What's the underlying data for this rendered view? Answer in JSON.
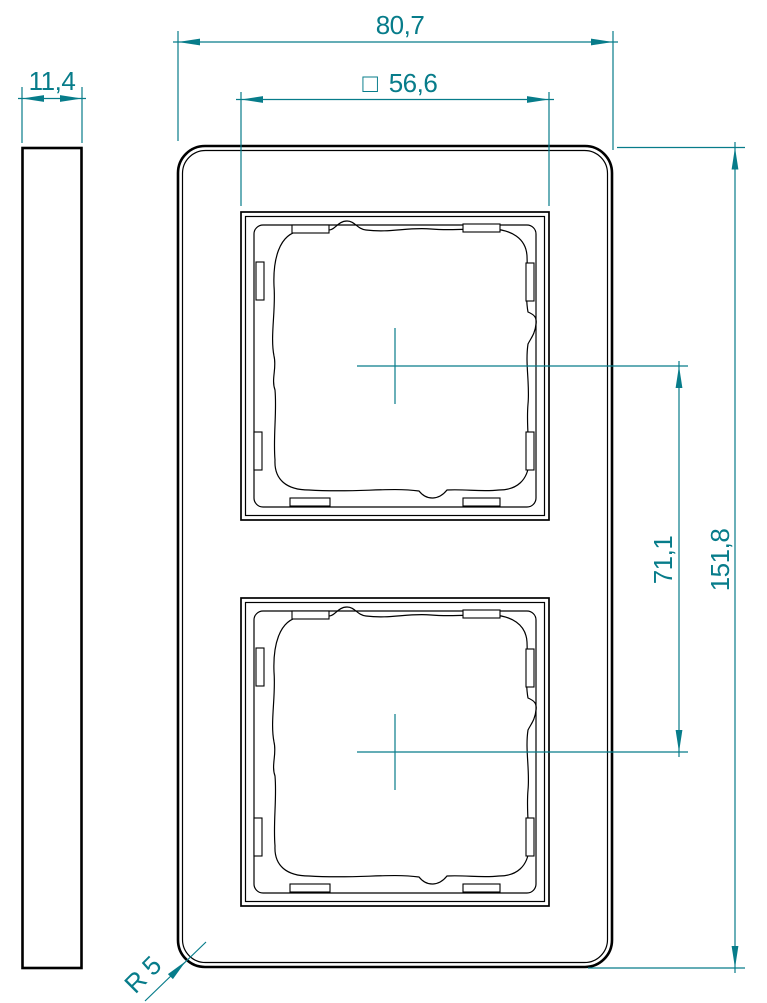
{
  "drawing": {
    "colors": {
      "dimension": "#077c8a",
      "outline": "#000000",
      "background": "#ffffff"
    },
    "dimensions": {
      "frame_width": "80,7",
      "opening_square_symbol": "□",
      "opening_square": "56,6",
      "side_thickness": "11,4",
      "frame_height": "151,8",
      "opening_spacing": "71,1",
      "corner_radius": "R 5"
    }
  }
}
